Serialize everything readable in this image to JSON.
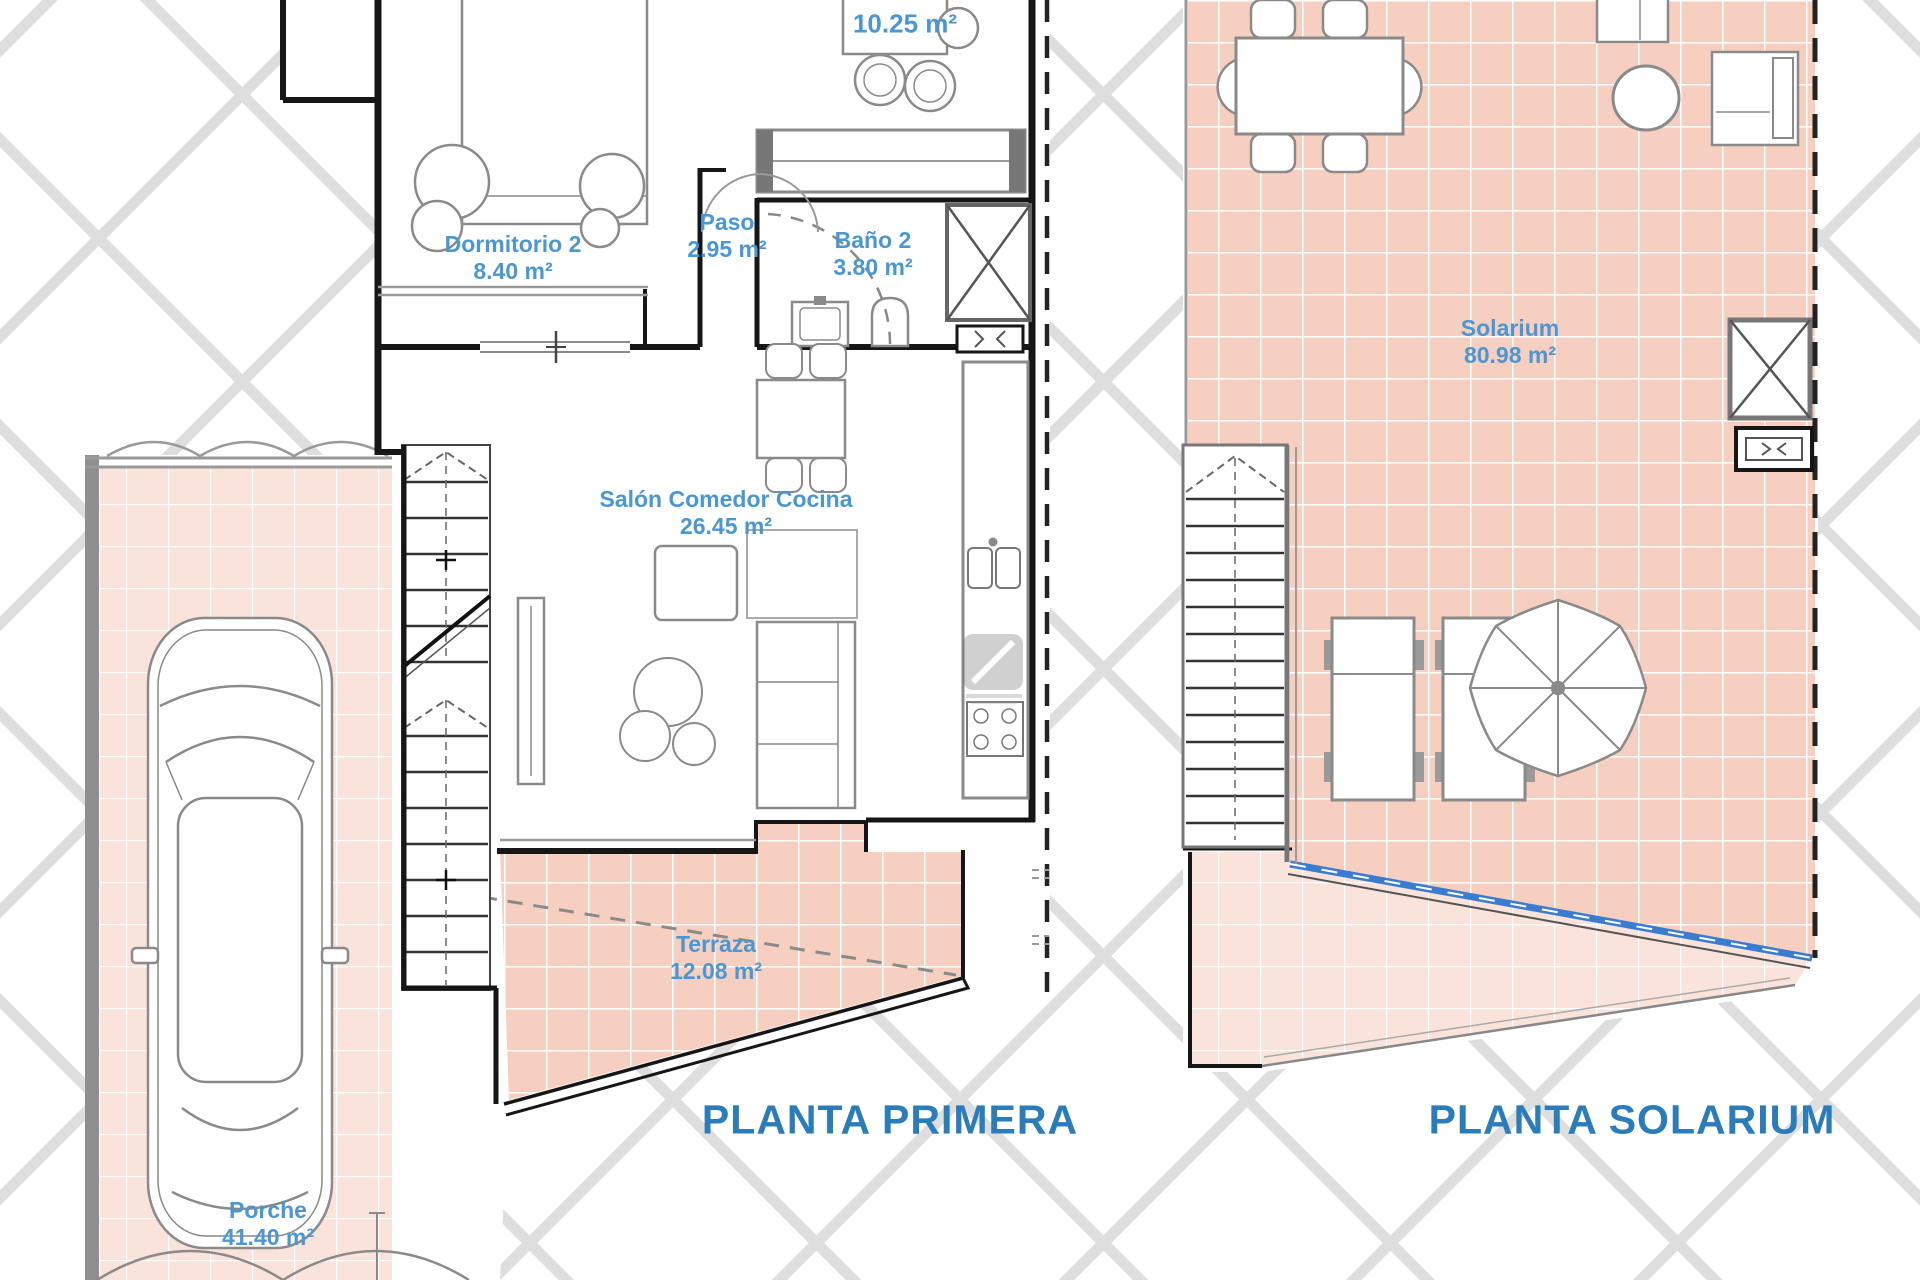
{
  "titles": {
    "primera": "PLANTA PRIMERA",
    "solarium": "PLANTA SOLARIUM"
  },
  "rooms": {
    "upper_bedroom": {
      "area": "10.25 m²"
    },
    "dormitorio2": {
      "name": "Dormitorio 2",
      "area": "8.40 m²"
    },
    "paso": {
      "name": "Paso",
      "area": "2.95 m²"
    },
    "bano2": {
      "name": "Baño 2",
      "area": "3.80 m²"
    },
    "salon": {
      "name": "Salón Comedor Cocina",
      "area": "26.45 m²"
    },
    "terraza": {
      "name": "Terraza",
      "area": "12.08 m²"
    },
    "porche": {
      "name": "Porche",
      "area": "41.40 m²"
    },
    "solarium": {
      "name": "Solarium",
      "area": "80.98 m²"
    }
  },
  "colors": {
    "label_blue": "#4a97d2",
    "title_blue": "#2b7cba",
    "tile_dark": "#f6cfc0",
    "tile_light": "#fae3da",
    "railing_blue": "#3a7cd0",
    "lattice_gray": "#dedede"
  }
}
